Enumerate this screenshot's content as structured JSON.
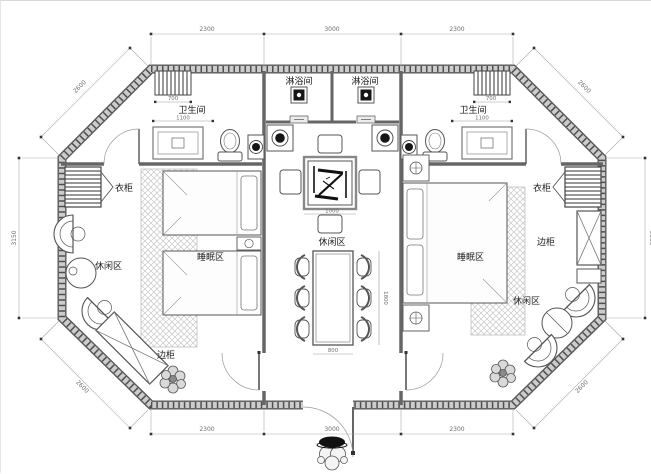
{
  "drawing_type": "octagonal-cabin-floor-plan",
  "colors": {
    "background": "#ffffff",
    "wall": "#555555",
    "wall_core": "#cccccc",
    "line": "#4a4a4a",
    "rug_hatch": "#c8c8c8",
    "label": "#1a1a1a",
    "dim": "#6e6e6e",
    "fixture_dark": "#161616"
  },
  "rooms": {
    "shower_left": "淋浴间",
    "shower_right": "淋浴间",
    "bathroom_left": "卫生间",
    "bathroom_right": "卫生间",
    "wardrobe_left": "衣柜",
    "wardrobe_right": "衣柜",
    "sleeping_left": "睡眠区",
    "sleeping_right": "睡眠区",
    "leisure_left": "休闲区",
    "leisure_center": "休闲区",
    "leisure_right": "休闲区",
    "side_cabinet_left": "边柜",
    "side_cabinet_right": "边柜"
  },
  "dimensions": {
    "top": [
      "2300",
      "3000",
      "2300"
    ],
    "bottom": [
      "2300",
      "3000",
      "2300"
    ],
    "left_side": "3150",
    "right_side": "3150",
    "diagonal": "2600",
    "radiator": "700",
    "bathroom_width": "1100",
    "tea_table": "1000",
    "dining_table_width": "800",
    "dining_table_length": "1800"
  }
}
